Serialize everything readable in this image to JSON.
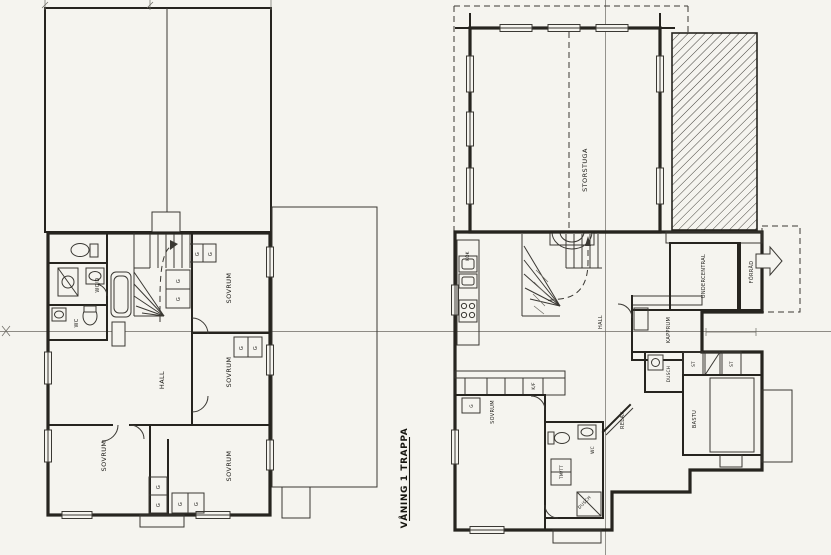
{
  "drawing": {
    "title": "VÅNING 1 TRAPPA",
    "paper_color": "#f5f4ef",
    "ink_color": "#26241f"
  },
  "left_plan": {
    "name": "upper-floor-plan",
    "labels": {
      "wc_d": "WC/D",
      "wc": "WC",
      "hall": "HALL",
      "sovrum_ne": "SOVRUM",
      "sovrum_e": "SOVRUM",
      "sovrum_sw": "SOVRUM",
      "sovrum_s": "SOVRUM",
      "closet": "G"
    }
  },
  "right_plan": {
    "name": "ground-floor-plan",
    "labels": {
      "storstuga": "STORSTUGA",
      "kok": "KÖK",
      "hall": "HALL",
      "kapprum": "KAPPRUM",
      "undercentral": "UNDERCENTRAL",
      "forrad": "FÖRRÅD",
      "dusch": "DUSCH",
      "dusch_bad": "DUSCH",
      "wc": "WC",
      "tvatt": "TM/TT",
      "bastu": "BASTU",
      "relax": "RELAX",
      "sovrum": "SOVRUM",
      "closet": "G",
      "st": "ST",
      "kyl_frys": "K/F"
    }
  }
}
